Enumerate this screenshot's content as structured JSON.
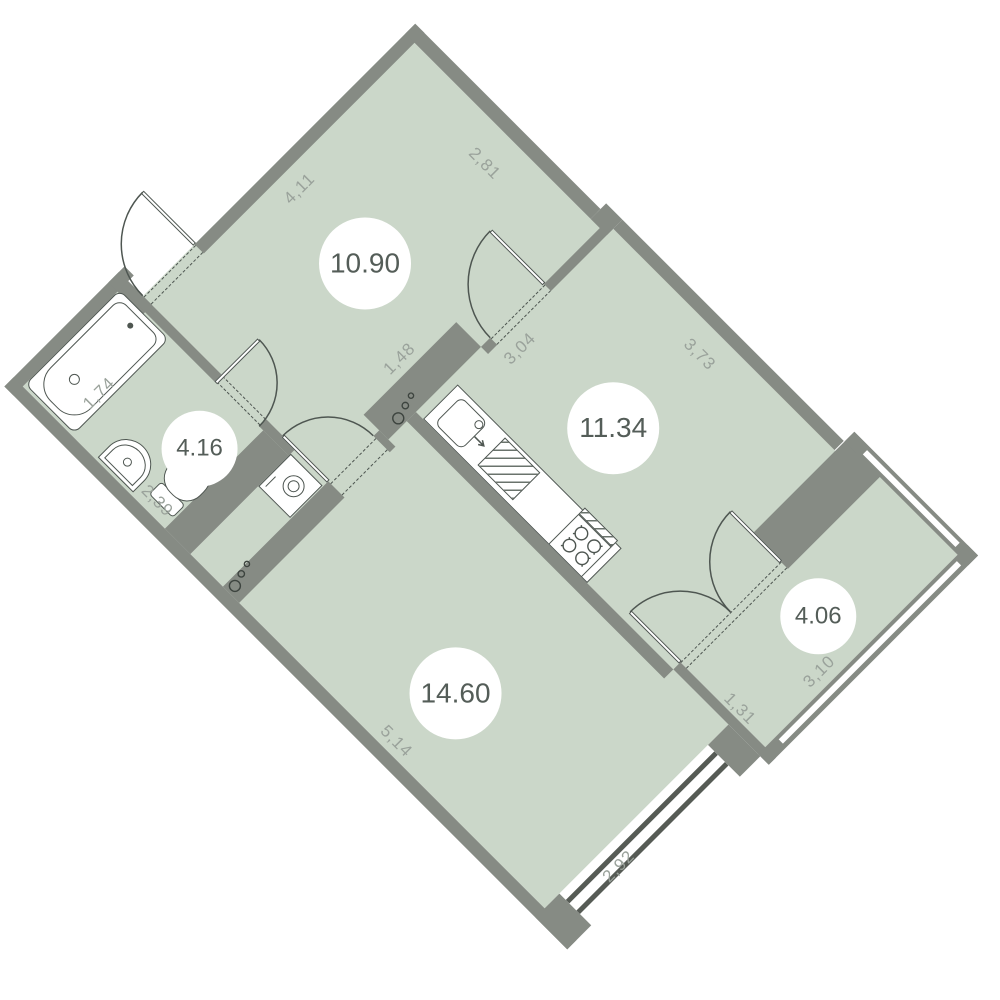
{
  "plan": {
    "rooms": [
      {
        "id": "hallway",
        "area": "10.90"
      },
      {
        "id": "bathroom",
        "area": "4.16"
      },
      {
        "id": "kitchen",
        "area": "11.34"
      },
      {
        "id": "living-room",
        "area": "14.60"
      },
      {
        "id": "balcony",
        "area": "4.06"
      }
    ],
    "dimensions": {
      "hallway_top": "4,11",
      "hallway_right": "2,81",
      "hallway_inner_wall": "1,48",
      "kitchen_top": "3,04",
      "kitchen_right": "3,73",
      "bathtub_length": "1,74",
      "bathroom_side": "2,39",
      "living_side": "5,14",
      "living_window": "2,92",
      "balcony_depth": "1,31",
      "balcony_width": "3,10"
    },
    "colors": {
      "floor": "#cbd7c9",
      "wall": "#868b84",
      "line": "#4e5651",
      "dimension_text": "#9aa29b",
      "area_text": "#545d58"
    },
    "fixtures": [
      "bathtub",
      "wash-basin",
      "toilet",
      "washing-machine",
      "kitchen-counter",
      "kitchen-sink",
      "drying-rack",
      "stove",
      "entrance-door",
      "bathroom-door",
      "kitchen-door",
      "living-room-door",
      "balcony-french-door",
      "window",
      "power-sockets"
    ]
  }
}
